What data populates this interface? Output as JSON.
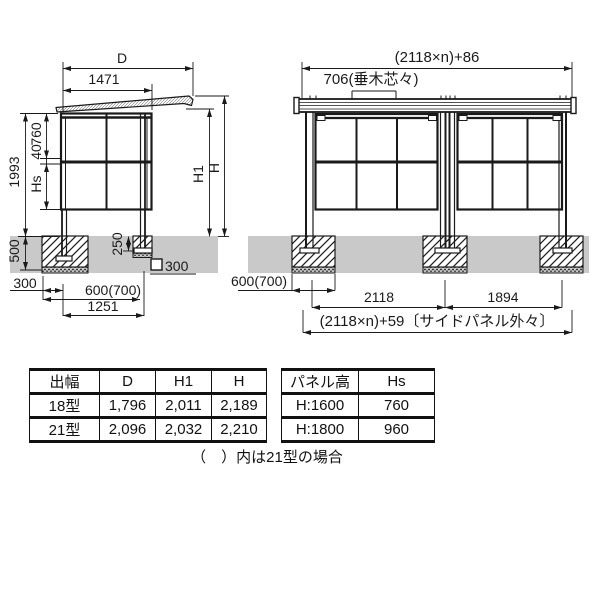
{
  "left_view": {
    "dims": {
      "d": "D",
      "depth_1471": "1471",
      "height_1993": "1993",
      "upper_760": "760",
      "rail_40": "40",
      "panel_hs": "Hs",
      "h1": "H1",
      "h": "H",
      "embed_500": "500",
      "front_embed_250": "250",
      "anchor_square_300": "300",
      "offset_300": "300",
      "footing_600": "600(700)",
      "span_1251": "1251"
    }
  },
  "right_view": {
    "dims": {
      "total_width": "(2118×n)+86",
      "rafter_pitch": "706(垂木芯々)",
      "footing_600": "600(700)",
      "bay_2118": "2118",
      "bay_1894": "1894",
      "panel_outer": "(2118×n)+59〔サイドパネル外々〕"
    }
  },
  "tables": {
    "size": {
      "headers": [
        "出幅",
        "D",
        "H1",
        "H"
      ],
      "rows": [
        [
          "18型",
          "1,796",
          "2,011",
          "2,189"
        ],
        [
          "21型",
          "2,096",
          "2,032",
          "2,210"
        ]
      ]
    },
    "panel": {
      "headers": [
        "パネル高",
        "Hs"
      ],
      "rows": [
        [
          "H:1600",
          "760"
        ],
        [
          "H:1800",
          "960"
        ]
      ]
    }
  },
  "note": "（　）内は21型の場合",
  "colors": {
    "ground": "#c9c9c9",
    "line": "#1a1a1a"
  }
}
